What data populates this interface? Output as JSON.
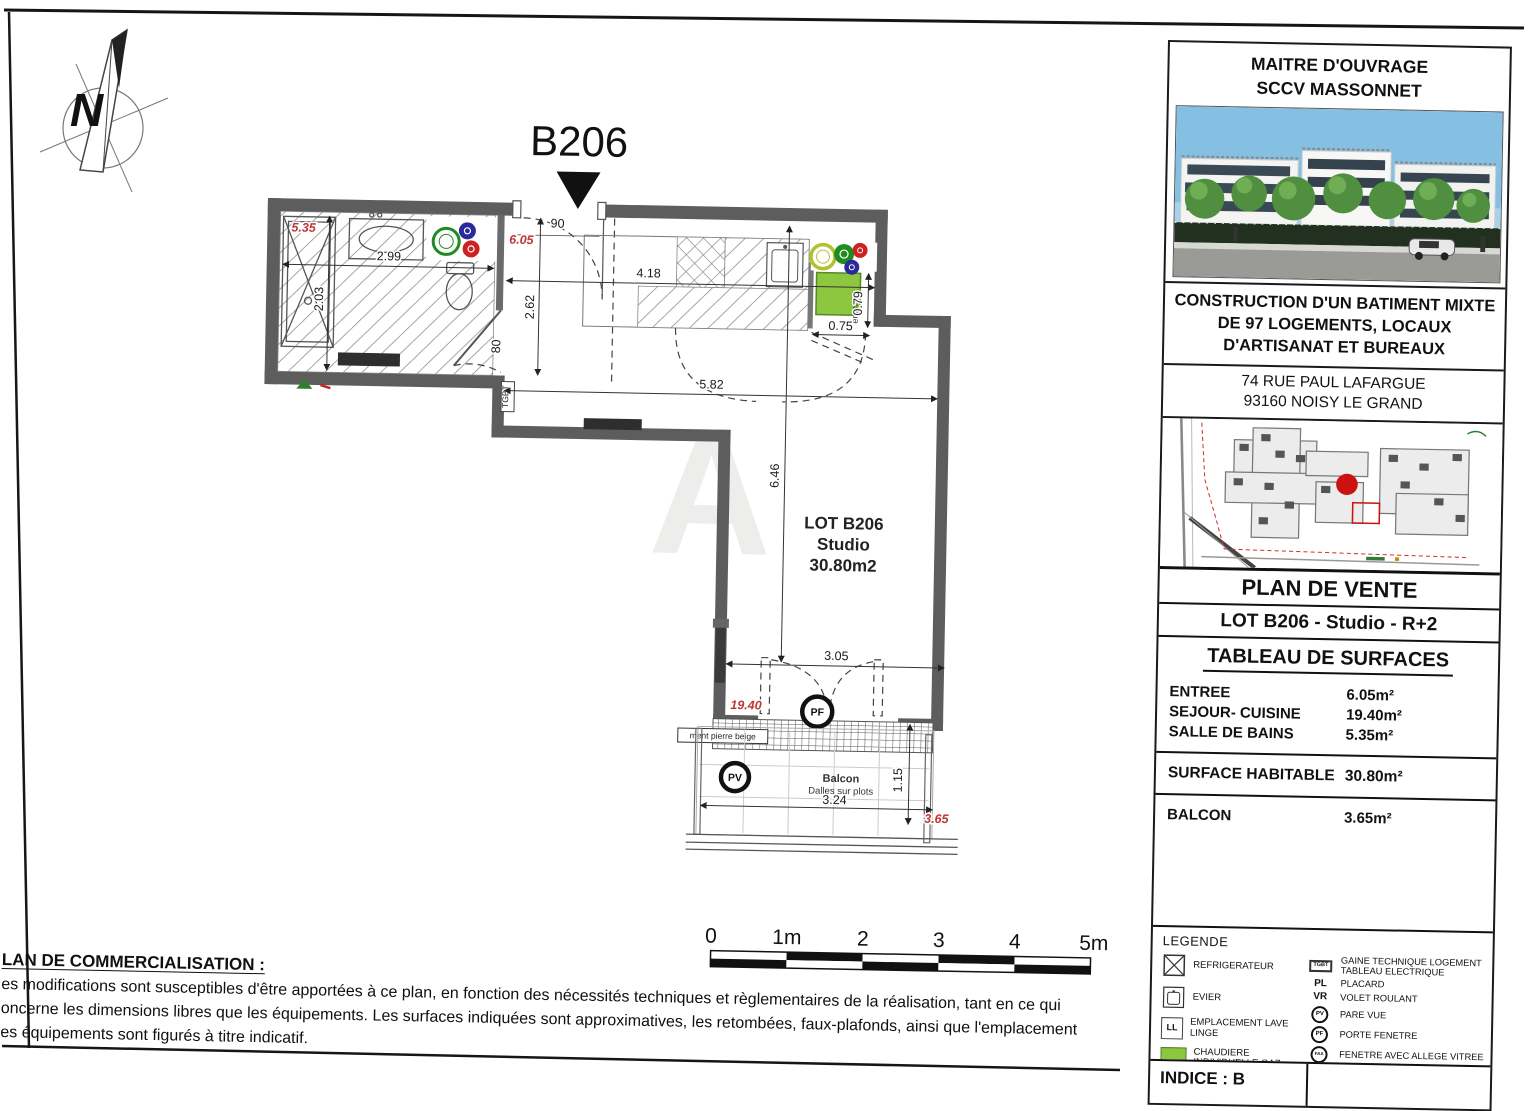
{
  "plan": {
    "unit_label": "B206",
    "north_letter": "N",
    "watermark": "A",
    "room": {
      "line1": "LOT B206",
      "line2": "Studio",
      "line3": "30.80m2"
    },
    "dims": {
      "bath_area": "5.35",
      "bath_width": "2.99",
      "bath_depth": "2.03",
      "entry_door": "90",
      "entree_area": "6.05",
      "kitchen_width": "4.18",
      "entree_depth": "2.62",
      "bath_door": "80",
      "sejour_width": "5.82",
      "ll_width": "0.75",
      "ll_depth": "0.79",
      "sejour_height": "6.46",
      "bay_width": "3.05",
      "sejour_area": "19.40",
      "balcon_width": "3.24",
      "balcon_depth": "1.15",
      "balcon_area": "3.65"
    },
    "labels": {
      "tgbt": "TGBT",
      "empl_ll": "empl. LL",
      "pierre": "ment pierre beige",
      "balcon": "Balcon",
      "dalles": "Dalles sur plots",
      "pf": "PF",
      "pv": "PV"
    }
  },
  "scalebar": {
    "labels": [
      "0",
      "1m",
      "2",
      "3",
      "4",
      "5m"
    ]
  },
  "disclaimer": {
    "title": "LAN DE COMMERCIALISATION :",
    "line1": "es modifications sont susceptibles d'être apportées à ce plan, en fonction des nécessités techniques et règlementaires de la réalisation, tant en ce qui",
    "line2": "oncerne les dimensions libres que les équipements. Les surfaces indiquées sont approximatives, les retombées, faux-plafonds, ainsi que l'emplacement",
    "line3": "es équipements sont figurés à titre indicatif."
  },
  "titleblock": {
    "owner_line1": "MAITRE D'OUVRAGE",
    "owner_line2": "SCCV MASSONNET",
    "project_line1": "CONSTRUCTION D'UN BATIMENT MIXTE",
    "project_line2": "DE 97 LOGEMENTS, LOCAUX",
    "project_line3": "D'ARTISANAT ET BUREAUX",
    "address_line1": "74 RUE PAUL LAFARGUE",
    "address_line2": "93160 NOISY LE GRAND",
    "plan_type": "PLAN DE VENTE",
    "lot_title": "LOT B206 - Studio - R+2",
    "surfaces": {
      "title": "TABLEAU DE SURFACES",
      "rows": [
        {
          "label": "ENTREE",
          "value": "6.05m²"
        },
        {
          "label": "SEJOUR- CUISINE",
          "value": "19.40m²"
        },
        {
          "label": "SALLE DE BAINS",
          "value": "5.35m²"
        }
      ],
      "habitable_label": "SURFACE HABITABLE",
      "habitable_value": "30.80m²",
      "balcon_label": "BALCON",
      "balcon_value": "3.65m²"
    },
    "legend": {
      "title": "LEGENDE",
      "refrigerateur": "REFRIGERATEUR",
      "evier": "EVIER",
      "ll_abbr": "LL",
      "lave_linge": "EMPLACEMENT LAVE LINGE",
      "chaudiere": "CHAUDIERE INDIVIDUELLE GAZ",
      "tgbt_abbr": "TGBT",
      "tgbt": "GAINE TECHNIQUE LOGEMENT TABLEAU ELECTRIQUE",
      "pl_abbr": "PL",
      "placard": "PLACARD",
      "vr_abbr": "VR",
      "volet": "VOLET ROULANT",
      "pv_abbr": "PV",
      "pare_vue": "PARE VUE",
      "pf_abbr": "PF",
      "porte_fenetre": "PORTE FENETRE",
      "faa_abbr": "FAA",
      "fenetre_allege": "FENETRE AVEC ALLEGE VITREE",
      "faux_plafond": "FAUX-PLAFOND / SOFFITE",
      "decalage": "DECALAGE NIVEAU - MARCHE",
      "cloison": "CLOISON - FUSIBLE"
    },
    "indice": "INDICE : B"
  }
}
